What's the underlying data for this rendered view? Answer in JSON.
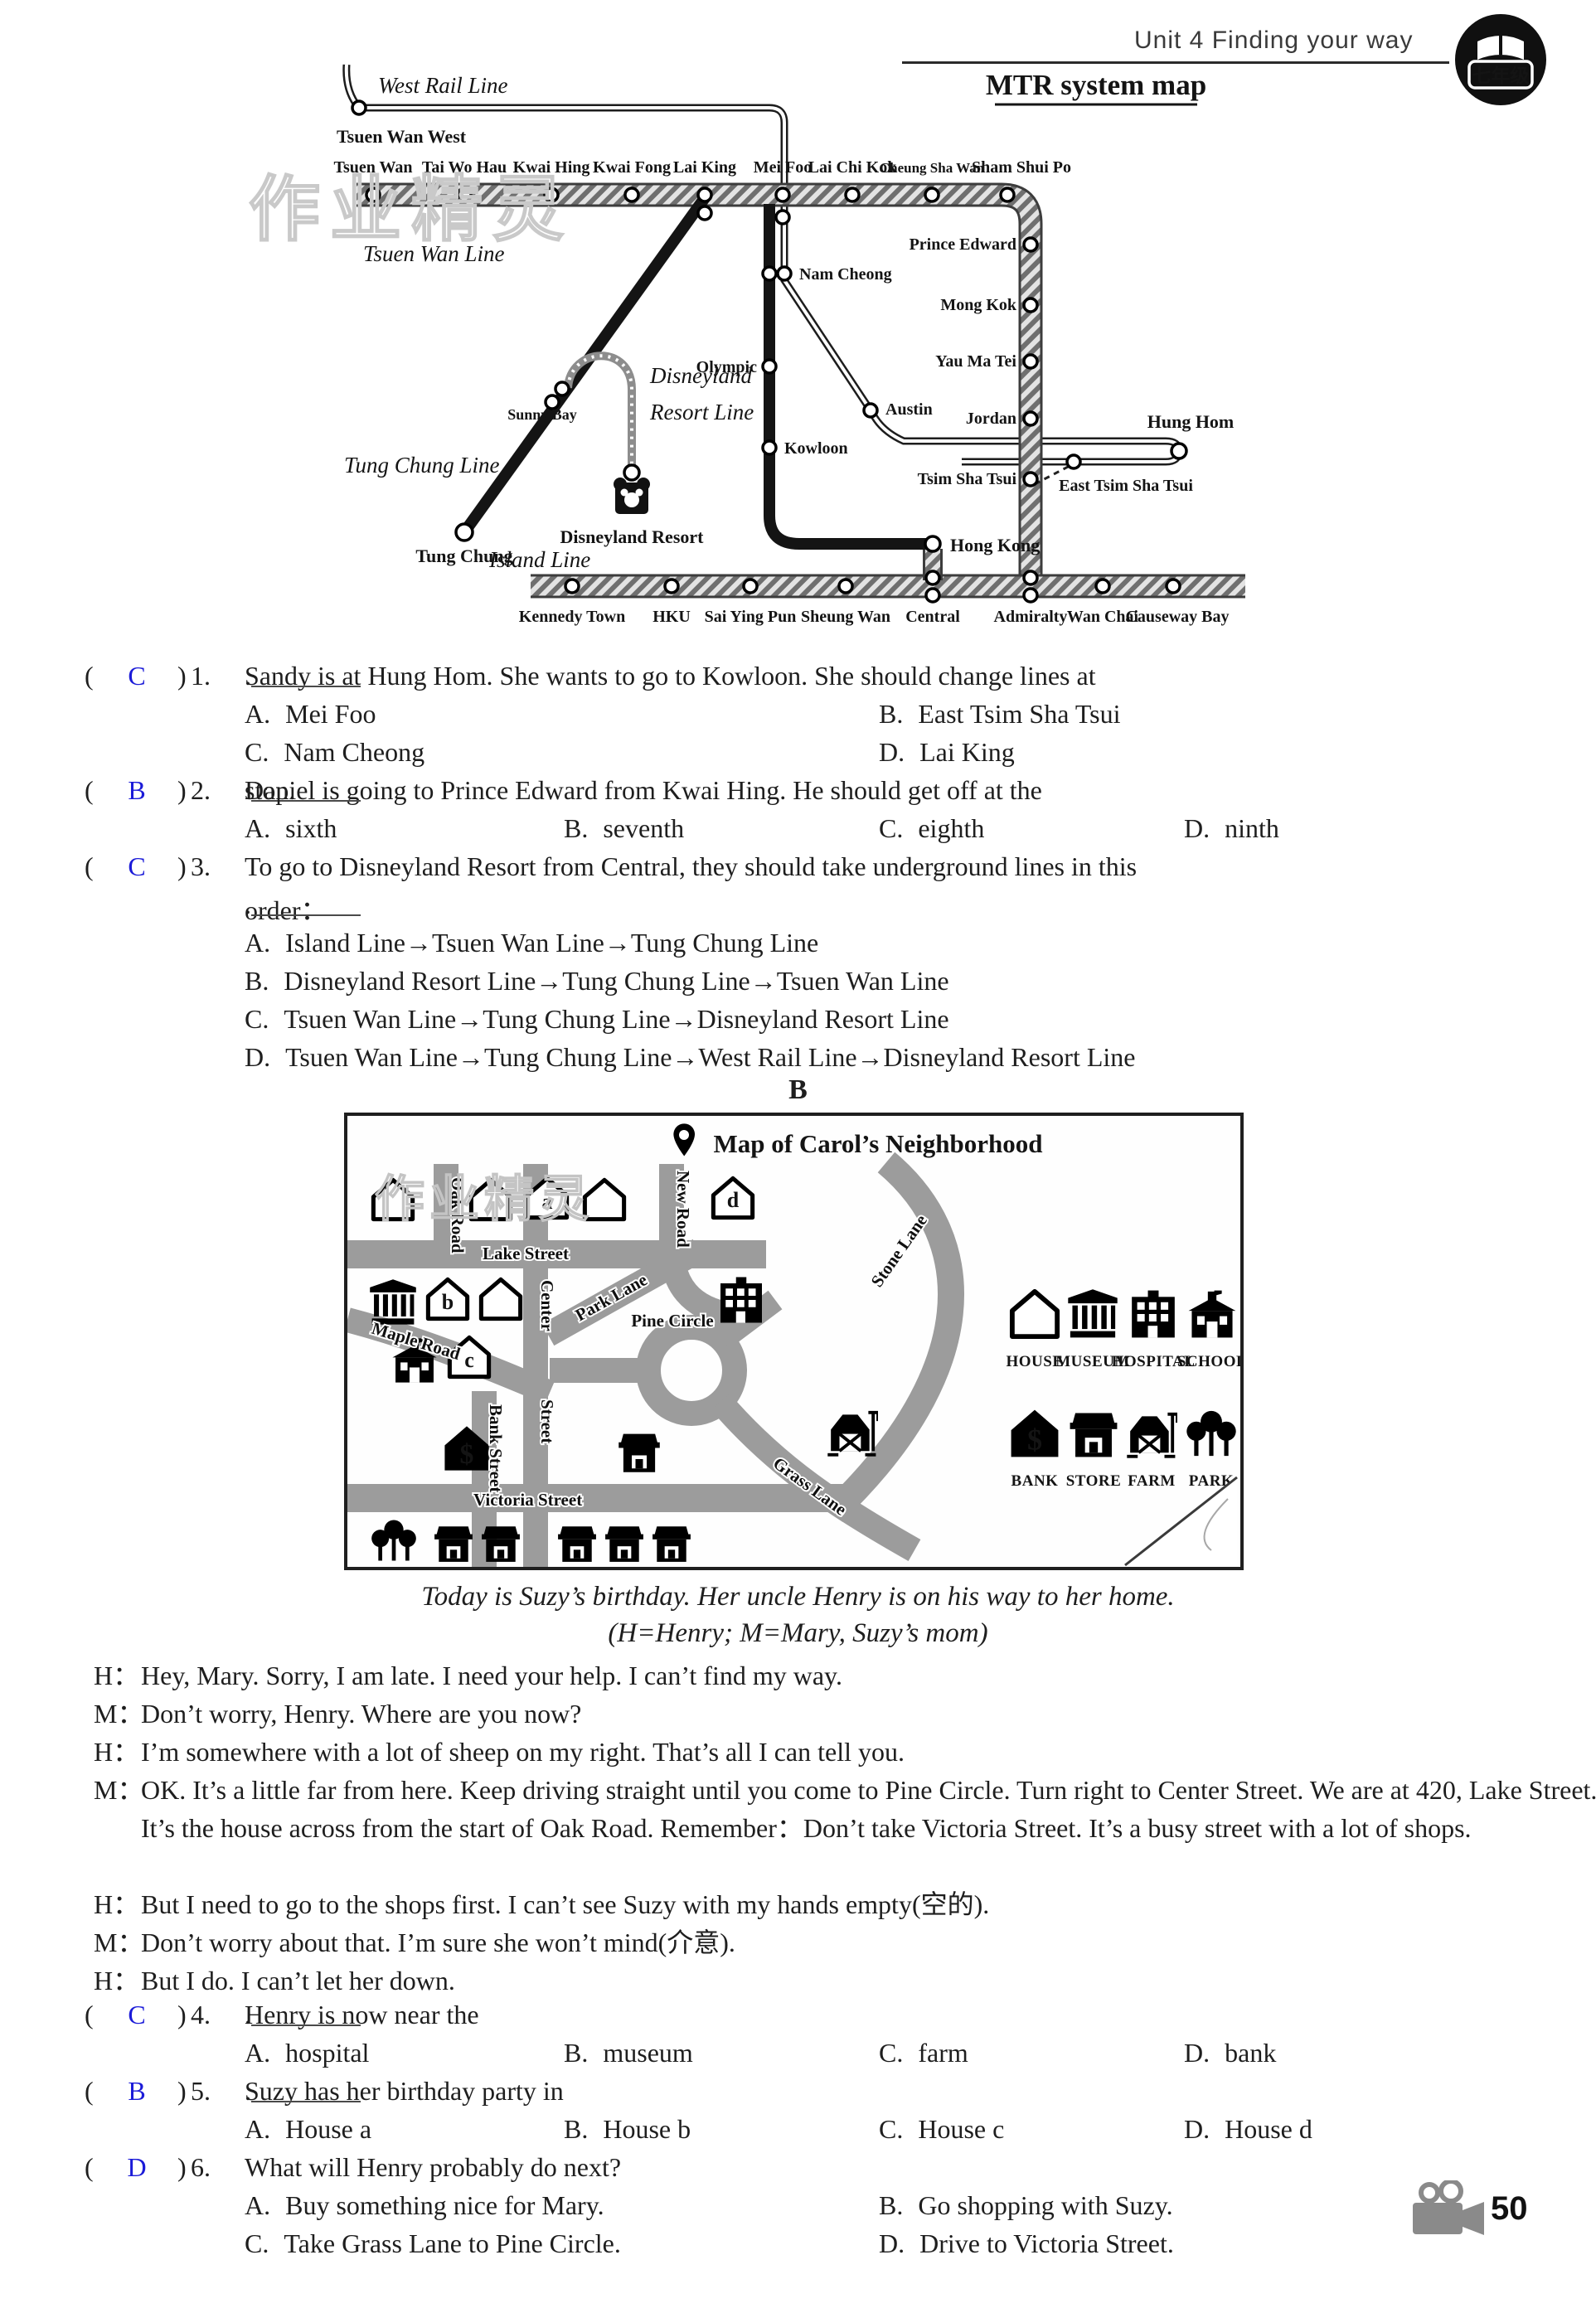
{
  "ui": {
    "open": "(",
    "close": ")"
  },
  "header": {
    "unit_title": "Unit 4   Finding your way",
    "badge": "七年级"
  },
  "watermark": "作业精灵",
  "sections": {
    "b": "B"
  },
  "footer": {
    "page": "50"
  },
  "mtr": {
    "title": "MTR system map",
    "lines": {
      "west_rail": "West Rail Line",
      "tsuen_wan": "Tsuen Wan Line",
      "tung_chung": "Tung Chung Line",
      "disney1": "Disneyland",
      "disney2": "Resort Line",
      "island": "Island Line"
    },
    "st": {
      "tsuen_wan_west": "Tsuen Wan West",
      "top": [
        "Tsuen Wan",
        "Tai Wo Hau",
        "Kwai Hing",
        "Kwai Fong",
        "Lai King",
        "Mei Foo",
        "Lai Chi Kok",
        "Cheung Sha Wan",
        "Sham Shui Po"
      ],
      "right": [
        "Prince Edward",
        "Mong Kok",
        "Yau Ma Tei",
        "Jordan",
        "Tsim Sha Tsui"
      ],
      "nam_cheong": "Nam Cheong",
      "olympic": "Olympic",
      "kowloon": "Kowloon",
      "austin": "Austin",
      "sunny_bay": "Sunny Bay",
      "tung_chung": "Tung Chung",
      "disneyland_resort": "Disneyland Resort",
      "hung_hom": "Hung Hom",
      "east_tsim_sha_tsui": "East Tsim Sha Tsui",
      "hong_kong": "Hong Kong",
      "island": [
        "Kennedy Town",
        "HKU",
        "Sai Ying Pun",
        "Sheung Wan",
        "Central",
        "Admiralty",
        "Wan Chai",
        "Causeway Bay"
      ]
    }
  },
  "qa": [
    {
      "num": "1.",
      "ans": "C",
      "before": "Sandy is at Hung Hom.  She wants to go to Kowloon.  She should change lines at",
      "after": ".",
      "opts": [
        {
          "k": "A.",
          "t": "Mei Foo"
        },
        {
          "k": "B.",
          "t": "East Tsim Sha Tsui"
        },
        {
          "k": "C.",
          "t": "Nam Cheong"
        },
        {
          "k": "D.",
          "t": "Lai King"
        }
      ]
    },
    {
      "num": "2.",
      "ans": "B",
      "before": "Daniel is going to Prince Edward from Kwai Hing.  He should get off at the",
      "after": " stop.",
      "opts": [
        {
          "k": "A.",
          "t": "sixth"
        },
        {
          "k": "B.",
          "t": "seventh"
        },
        {
          "k": "C.",
          "t": "eighth"
        },
        {
          "k": "D.",
          "t": "ninth"
        }
      ]
    },
    {
      "num": "3.",
      "ans": "C",
      "line1": "To go to Disneyland Resort from Central, they should take underground lines in this",
      "line2": "order：",
      "after": ".",
      "opts": [
        {
          "k": "A.",
          "t": "Island Line→Tsuen Wan Line→Tung Chung Line"
        },
        {
          "k": "B.",
          "t": "Disneyland Resort Line→Tung Chung Line→Tsuen Wan Line"
        },
        {
          "k": "C.",
          "t": "Tsuen Wan Line→Tung Chung Line→Disneyland Resort Line"
        },
        {
          "k": "D.",
          "t": "Tsuen Wan Line→Tung Chung Line→West Rail Line→Disneyland Resort Line"
        }
      ]
    }
  ],
  "carol": {
    "title": "Map of Carol’s Neighborhood",
    "streets": {
      "oak": "Oak Road",
      "lake": "Lake Street",
      "new": "New Road",
      "center1": "Center",
      "center2": "Street",
      "park": "Park Lane",
      "pine": "Pine Circle",
      "stone": "Stone Lane",
      "maple": "Maple Road",
      "bank": "Bank Street",
      "victoria": "Victoria Street",
      "grass": "Grass Lane"
    },
    "houses": {
      "a": "a",
      "b": "b",
      "c": "c",
      "d": "d"
    },
    "legend": [
      {
        "icon": "house",
        "label": "HOUSE"
      },
      {
        "icon": "museum",
        "label": "MUSEUM"
      },
      {
        "icon": "hospital",
        "label": "HOSPITAL"
      },
      {
        "icon": "school",
        "label": "SCHOOL"
      },
      {
        "icon": "bank",
        "label": "BANK"
      },
      {
        "icon": "store",
        "label": "STORE"
      },
      {
        "icon": "farm",
        "label": "FARM"
      },
      {
        "icon": "park",
        "label": "PARK"
      }
    ]
  },
  "passage": {
    "intro1": "Today is Suzy’s birthday.  Her uncle Henry is on his way to her home.",
    "intro2": "(H=Henry; M=Mary, Suzy’s mom)",
    "d": [
      {
        "s": "H：",
        "t": "Hey, Mary.  Sorry, I am late.  I need your help.  I can’t find my way."
      },
      {
        "s": "M：",
        "t": "Don’t worry, Henry.  Where are you now?"
      },
      {
        "s": "H：",
        "t": "I’m somewhere with a lot of sheep on my right. That’s all I can tell you."
      },
      {
        "s": "M：",
        "t": "OK.  It’s a little far from here.  Keep driving straight until you come to Pine Circle.  Turn right to Center Street.  We are at 420, Lake Street.  It’s the house across from the start of Oak Road.  Remember：Don’t take Victoria Street.  It’s a busy street with a lot of shops."
      },
      {
        "s": "H：",
        "t": "But I need to go to the shops first.  I can’t see Suzy with my hands empty(空的)."
      },
      {
        "s": "M：",
        "t": "Don’t worry about that.  I’m sure she won’t mind(介意)."
      },
      {
        "s": "H：",
        "t": "But I do.  I can’t let her down."
      }
    ]
  },
  "qb": [
    {
      "num": "4.",
      "ans": "C",
      "before": "Henry is now near the",
      "after": ".",
      "opts": [
        {
          "k": "A.",
          "t": "hospital"
        },
        {
          "k": "B.",
          "t": "museum"
        },
        {
          "k": "C.",
          "t": "farm"
        },
        {
          "k": "D.",
          "t": "bank"
        }
      ]
    },
    {
      "num": "5.",
      "ans": "B",
      "before": "Suzy has her birthday party in",
      "after": ".",
      "opts": [
        {
          "k": "A.",
          "t": "House a"
        },
        {
          "k": "B.",
          "t": "House b"
        },
        {
          "k": "C.",
          "t": "House c"
        },
        {
          "k": "D.",
          "t": "House d"
        }
      ]
    },
    {
      "num": "6.",
      "ans": "D",
      "stem": "What will Henry probably do next?",
      "opts": [
        {
          "k": "A.",
          "t": "Buy something nice for Mary."
        },
        {
          "k": "B.",
          "t": "Go shopping with Suzy."
        },
        {
          "k": "C.",
          "t": "Take Grass Lane to Pine Circle."
        },
        {
          "k": "D.",
          "t": "Drive to Victoria Street."
        }
      ]
    }
  ]
}
